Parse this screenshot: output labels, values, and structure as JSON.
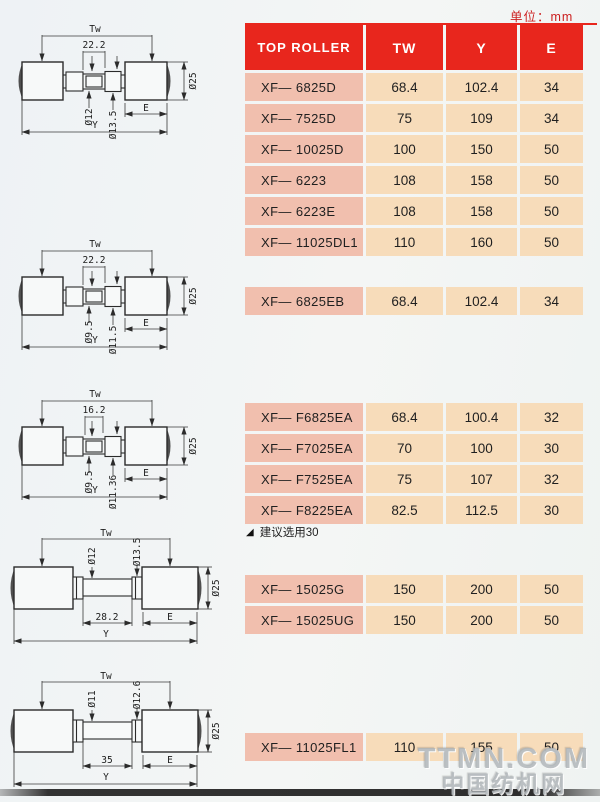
{
  "page": {
    "unit_label": "单位：mm",
    "note": {
      "marker": "◢",
      "text": "建议选用30"
    },
    "watermark": {
      "line1": "TTMN.COM",
      "line2": "中国纺机网"
    }
  },
  "colors": {
    "header_bg": "#e8261d",
    "label_bg": "#f1bfae",
    "value_bg": "#f7dcba"
  },
  "table": {
    "headers": {
      "model": "TOP ROLLER",
      "tw": "TW",
      "y": "Y",
      "e": "E"
    },
    "blocks": [
      {
        "rows": [
          {
            "model": "XF— 6825D",
            "tw": "68.4",
            "y": "102.4",
            "e": "34"
          },
          {
            "model": "XF— 7525D",
            "tw": "75",
            "y": "109",
            "e": "34"
          },
          {
            "model": "XF— 10025D",
            "tw": "100",
            "y": "150",
            "e": "50"
          },
          {
            "model": "XF— 6223",
            "tw": "108",
            "y": "158",
            "e": "50"
          },
          {
            "model": "XF— 6223E",
            "tw": "108",
            "y": "158",
            "e": "50"
          },
          {
            "model": "XF— 11025DL1",
            "tw": "110",
            "y": "160",
            "e": "50"
          }
        ]
      },
      {
        "rows": [
          {
            "model": "XF— 6825EB",
            "tw": "68.4",
            "y": "102.4",
            "e": "34"
          }
        ]
      },
      {
        "rows": [
          {
            "model": "XF— F6825EA",
            "tw": "68.4",
            "y": "100.4",
            "e": "32",
            "marker": "◢"
          },
          {
            "model": "XF— F7025EA",
            "tw": "70",
            "y": "100",
            "e": "30"
          },
          {
            "model": "XF— F7525EA",
            "tw": "75",
            "y": "107",
            "e": "32",
            "marker": "◢"
          },
          {
            "model": "XF— F8225EA",
            "tw": "82.5",
            "y": "112.5",
            "e": "30"
          }
        ]
      },
      {
        "rows": [
          {
            "model": "XF— 15025G",
            "tw": "150",
            "y": "200",
            "e": "50"
          },
          {
            "model": "XF— 15025UG",
            "tw": "150",
            "y": "200",
            "e": "50"
          }
        ]
      },
      {
        "rows": [
          {
            "model": "XF— 11025FL1",
            "tw": "110",
            "y": "155",
            "e": "50"
          }
        ]
      }
    ]
  },
  "diagrams": [
    {
      "span": "Tw",
      "width": "22.2",
      "bore": "Ø12",
      "bush": "Ø13.5",
      "roller": "Ø25",
      "e": "E",
      "y": "Y"
    },
    {
      "span": "Tw",
      "width": "22.2",
      "bore": "Ø9.5",
      "bush": "Ø11.5",
      "roller": "Ø25",
      "e": "E",
      "y": "Y"
    },
    {
      "span": "Tw",
      "width": "16.2",
      "bore": "Ø9.5",
      "bush": "Ø11.36",
      "roller": "Ø25",
      "e": "E",
      "y": "Y"
    },
    {
      "span": "Tw",
      "width": "28.2",
      "bore": "Ø12",
      "bush": "Ø13.5",
      "roller": "Ø25",
      "e": "E",
      "y": "Y"
    },
    {
      "span": "Tw",
      "width": "35",
      "bore": "Ø11",
      "bush": "Ø12.6",
      "roller": "Ø25",
      "e": "E",
      "y": "Y"
    }
  ]
}
